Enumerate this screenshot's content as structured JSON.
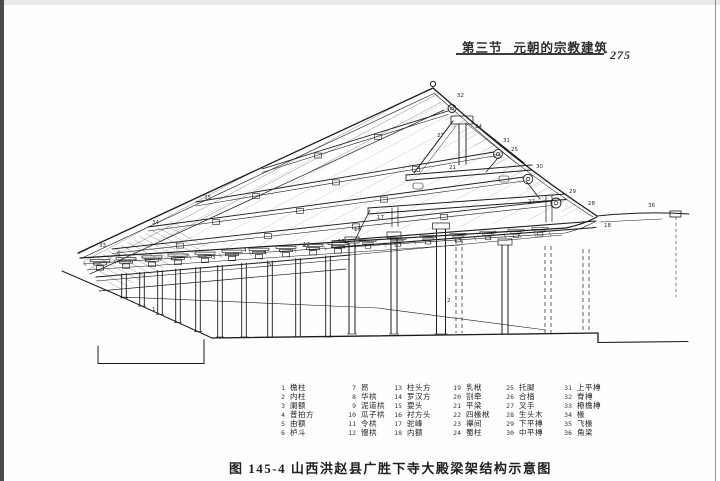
{
  "header": {
    "section_label": "第三节",
    "section_title": "元朝的宗教建筑",
    "page_number": "275"
  },
  "figure": {
    "caption": "图 145-4  山西洪赵县广胜下寺大殿梁架结构示意图",
    "part_labels": [
      {
        "no": "33",
        "x": 99,
        "y": 247
      },
      {
        "no": "34",
        "x": 152,
        "y": 224
      },
      {
        "no": "35",
        "x": 204,
        "y": 199
      },
      {
        "no": "32",
        "x": 457,
        "y": 97
      },
      {
        "no": "31",
        "x": 503,
        "y": 142
      },
      {
        "no": "30",
        "x": 536,
        "y": 168
      },
      {
        "no": "29",
        "x": 569,
        "y": 193
      },
      {
        "no": "28",
        "x": 588,
        "y": 205
      },
      {
        "no": "36",
        "x": 648,
        "y": 207
      },
      {
        "no": "27",
        "x": 437,
        "y": 137
      },
      {
        "no": "24",
        "x": 475,
        "y": 128
      },
      {
        "no": "25",
        "x": 511,
        "y": 151
      },
      {
        "no": "21",
        "x": 449,
        "y": 169
      },
      {
        "no": "23",
        "x": 494,
        "y": 158
      },
      {
        "no": "22",
        "x": 528,
        "y": 203
      },
      {
        "no": "19",
        "x": 354,
        "y": 231
      },
      {
        "no": "17",
        "x": 377,
        "y": 219
      },
      {
        "no": "18",
        "x": 604,
        "y": 227
      },
      {
        "no": "13",
        "x": 338,
        "y": 243
      },
      {
        "no": "12",
        "x": 303,
        "y": 246
      },
      {
        "no": "6",
        "x": 117,
        "y": 255
      },
      {
        "no": "3",
        "x": 212,
        "y": 259
      },
      {
        "no": "4",
        "x": 243,
        "y": 252
      },
      {
        "no": "5",
        "x": 268,
        "y": 266
      },
      {
        "no": "2",
        "x": 447,
        "y": 302
      },
      {
        "no": "1",
        "x": 152,
        "y": 311
      }
    ]
  },
  "legend": {
    "items": [
      {
        "no": "1",
        "term": "檐柱"
      },
      {
        "no": "2",
        "term": "内柱"
      },
      {
        "no": "3",
        "term": "阑额"
      },
      {
        "no": "4",
        "term": "普拍方"
      },
      {
        "no": "5",
        "term": "由额"
      },
      {
        "no": "6",
        "term": "栌斗"
      },
      {
        "no": "7",
        "term": "昂"
      },
      {
        "no": "8",
        "term": "华栱"
      },
      {
        "no": "9",
        "term": "泥道栱"
      },
      {
        "no": "10",
        "term": "瓜子栱"
      },
      {
        "no": "11",
        "term": "令栱"
      },
      {
        "no": "12",
        "term": "慢栱"
      },
      {
        "no": "13",
        "term": "柱头方"
      },
      {
        "no": "14",
        "term": "罗汉方"
      },
      {
        "no": "15",
        "term": "耍头"
      },
      {
        "no": "16",
        "term": "衬方头"
      },
      {
        "no": "17",
        "term": "驼峰"
      },
      {
        "no": "18",
        "term": "内额"
      },
      {
        "no": "19",
        "term": "乳栿"
      },
      {
        "no": "20",
        "term": "劄牵"
      },
      {
        "no": "21",
        "term": "平梁"
      },
      {
        "no": "22",
        "term": "四椽栿"
      },
      {
        "no": "23",
        "term": "襻间"
      },
      {
        "no": "24",
        "term": "蜀柱"
      },
      {
        "no": "25",
        "term": "托脚"
      },
      {
        "no": "26",
        "term": "合㭼"
      },
      {
        "no": "27",
        "term": "叉手"
      },
      {
        "no": "28",
        "term": "生头木"
      },
      {
        "no": "29",
        "term": "下平槫"
      },
      {
        "no": "30",
        "term": "中平槫"
      },
      {
        "no": "31",
        "term": "上平槫"
      },
      {
        "no": "32",
        "term": "脊槫"
      },
      {
        "no": "33",
        "term": "橑檐槫"
      },
      {
        "no": "34",
        "term": "椽"
      },
      {
        "no": "35",
        "term": "飞椽"
      },
      {
        "no": "36",
        "term": "角梁"
      }
    ]
  }
}
